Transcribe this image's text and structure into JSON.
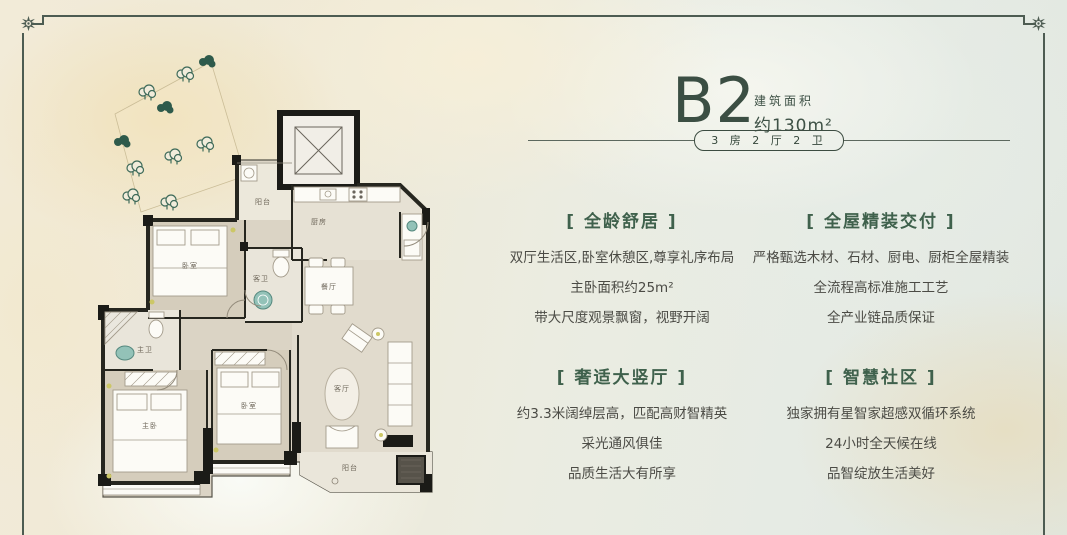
{
  "title": {
    "code": "B2",
    "area_label": "建筑面积",
    "area_value": "约130m²"
  },
  "spec": {
    "label": "3 房 2 厅 2 卫"
  },
  "features": [
    {
      "header": "[ 全龄舒居 ]",
      "lines": [
        "双厅生活区,卧室休憩区,尊享礼序布局",
        "主卧面积约25m²",
        "带大尺度观景飘窗，视野开阔"
      ]
    },
    {
      "header": "[ 全屋精装交付 ]",
      "lines": [
        "严格甄选木材、石材、厨电、厨柜全屋精装",
        "全流程高标准施工工艺",
        "全产业链品质保证"
      ]
    },
    {
      "header": "[ 奢适大竖厅 ]",
      "lines": [
        "约3.3米阔绰层高，匹配高财智精英",
        "采光通风俱佳",
        "品质生活大有所享"
      ]
    },
    {
      "header": "[ 智慧社区 ]",
      "lines": [
        "独家拥有星智家超感双循环系统",
        "24小时全天候在线",
        "品智绽放生活美好"
      ]
    }
  ],
  "floorplan": {
    "balcony_top": "阳台",
    "kitchen": "厨房",
    "guest_bath": "客卫",
    "dining": "餐厅",
    "living": "客厅",
    "master_bath": "主卫",
    "master_bedroom": "主卧",
    "bedroom_a": "卧室",
    "bedroom_b": "卧室",
    "balcony_bottom": "阳台"
  },
  "colors": {
    "accent_green": "#3b4e43",
    "header_green": "#3f614c",
    "body_text": "#4b4b45",
    "frame": "#4d5c52",
    "wall": "#26261f",
    "teal_fixture": "#93c2b8",
    "bg_cream": "#f2ebd8",
    "bg_sage": "#e4eae3"
  }
}
